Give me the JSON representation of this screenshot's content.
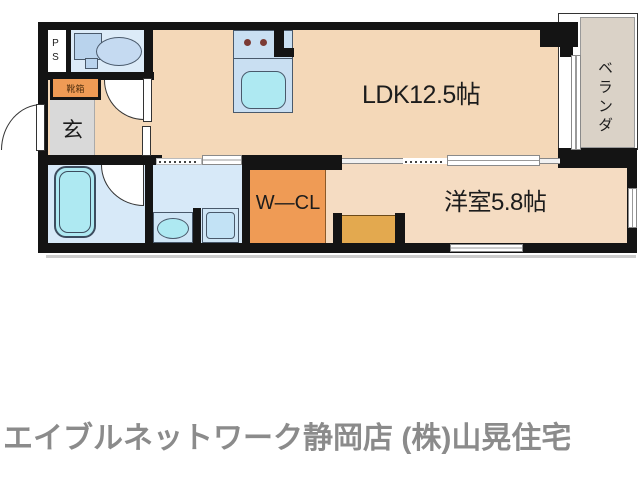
{
  "floorplan": {
    "labels": {
      "ldk": "LDK12.5帖",
      "western_room": "洋室5.8帖",
      "walk_in_closet": "W—CL",
      "veranda": "ベランダ",
      "entrance": "玄",
      "shoe_box": "靴箱",
      "pipe_space": "PS"
    },
    "colors": {
      "wall": "#141414",
      "floor_main": "#f4d8b8",
      "floor_western": "#f5dcc2",
      "orange": "#ef9b55",
      "closet_orange": "#e3a94f",
      "genkan_gray": "#d9d9d9",
      "water_blue": "#d7e9f8",
      "toilet_blue": "#dcebf8",
      "fixture_blue": "#c9dff2",
      "tub_cyan": "#aee9f2",
      "veranda_gray": "#dad2c7",
      "text_dark": "#1c1c1c",
      "footer_gray": "#8b8b8b"
    }
  },
  "footer": {
    "brand": "エイブルネットワーク静岡店 (株)山晃住宅"
  }
}
